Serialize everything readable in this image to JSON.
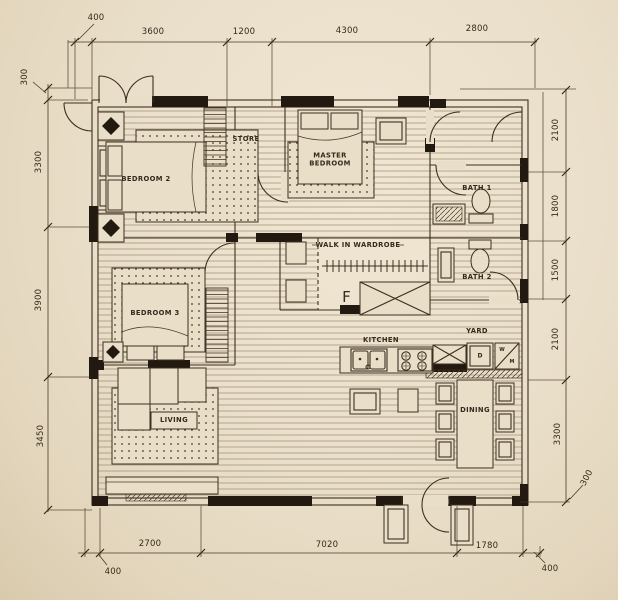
{
  "meta": {
    "type": "architectural floor plan drawing"
  },
  "palette": {
    "paper": "#e9dec8",
    "ink": "#3d2f20",
    "wall_black": "#221910",
    "window_grey": "#8d8170"
  },
  "rooms": {
    "bedroom2": "BEDROOM 2",
    "store": "STORE",
    "master_bedroom": "MASTER BEDROOM",
    "bath1": "BATH 1",
    "walk_in_wardrobe": "WALK IN WARDROBE",
    "bath2": "BATH 2",
    "bedroom3": "BEDROOM 3",
    "kitchen": "KITCHEN",
    "yard": "YARD",
    "living": "LIVING",
    "dining": "DINING"
  },
  "appliances": {
    "fridge": "F",
    "dryer": "D",
    "washer_top": "W",
    "washer_bottom": "M"
  },
  "dimensions_mm": {
    "top": [
      "400",
      "3600",
      "1200",
      "4300",
      "2800"
    ],
    "left": [
      "300",
      "3300",
      "3900",
      "3450"
    ],
    "right": [
      "2100",
      "1800",
      "1500",
      "2100",
      "3300",
      "300"
    ],
    "bottom": [
      "400",
      "2700",
      "7020",
      "1780",
      "400"
    ]
  }
}
